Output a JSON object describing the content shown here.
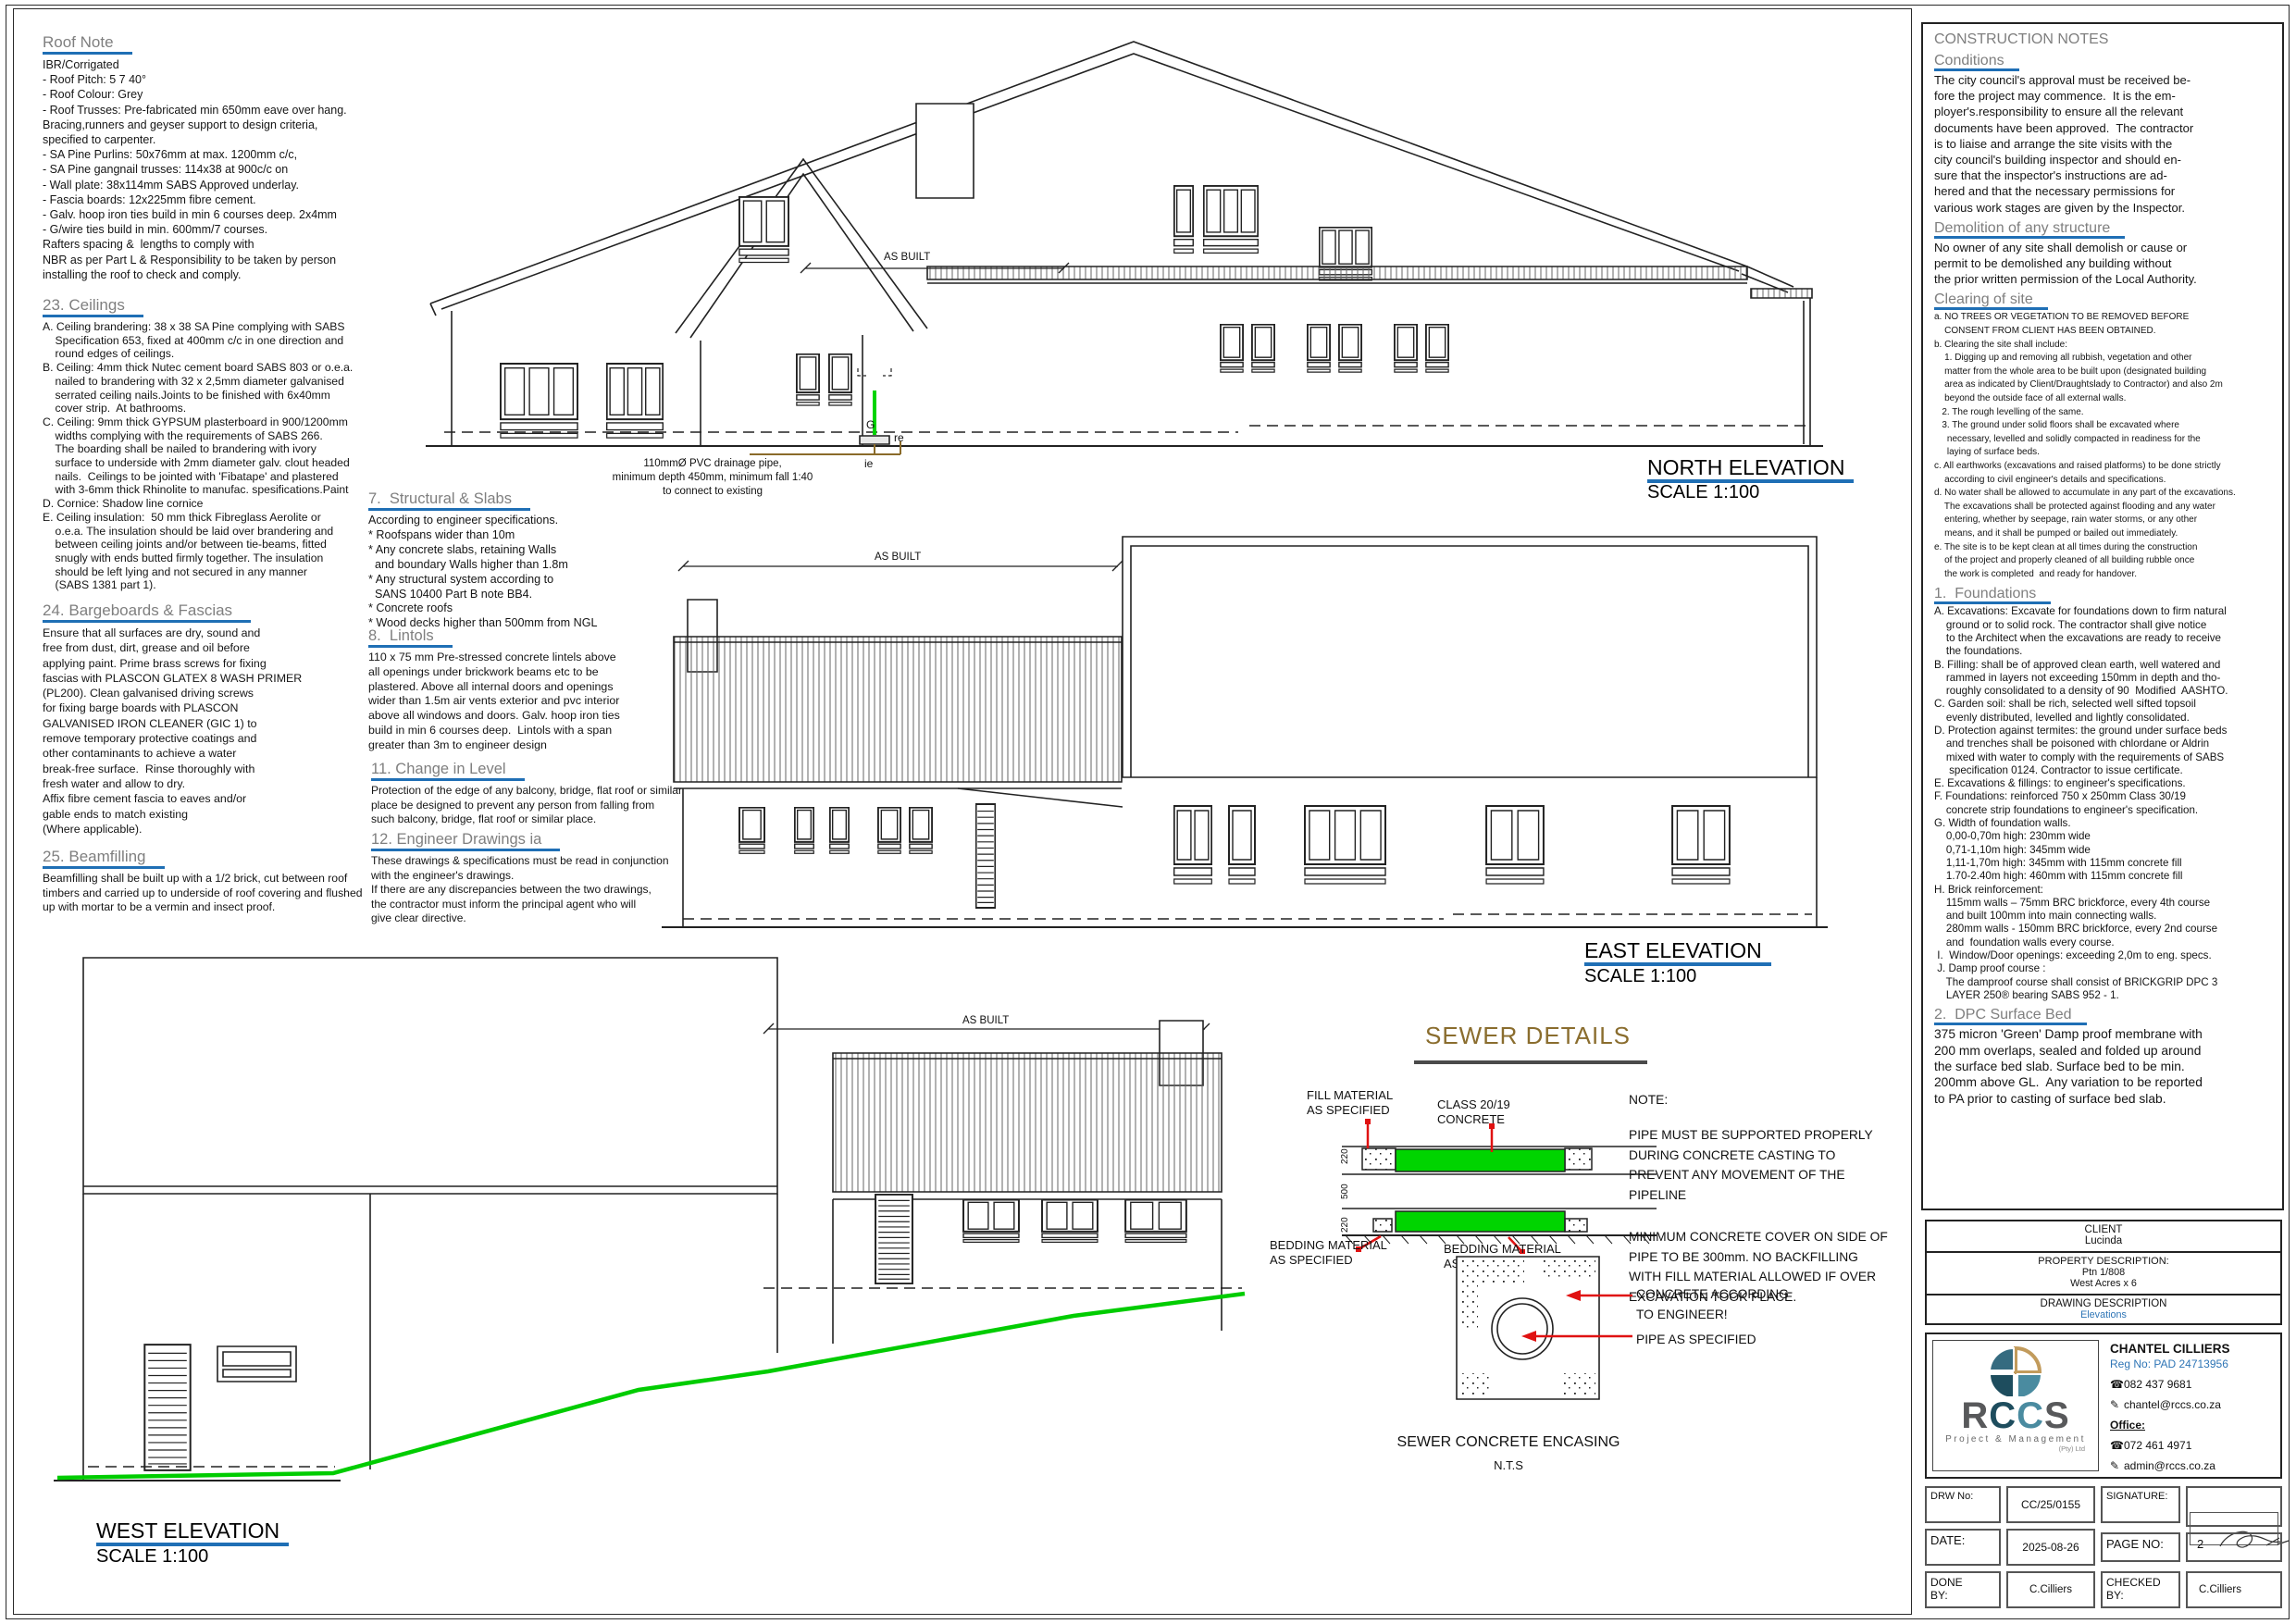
{
  "colors": {
    "accent_blue": "#1f6fb5",
    "link_blue": "#2e75b6",
    "heading_gray": "#7f7f7f",
    "pipe_green": "#00d400",
    "sewer_title_brown": "#8a6d2e",
    "leader_red": "#e01212"
  },
  "left": {
    "roof": {
      "title": "Roof Note",
      "lines": [
        "IBR/Corrigated",
        "- Roof Pitch: 5 7 40°",
        "- Roof Colour: Grey",
        "- Roof Trusses: Pre-fabricated min 650mm eave over hang.",
        "Bracing,runners and geyser support to design criteria,",
        "specified to carpenter.",
        "- SA Pine Purlins: 50x76mm at max. 1200mm c/c,",
        "- SA Pine gangnail trusses: 114x38 at 900c/c on",
        "- Wall plate: 38x114mm SABS Approved underlay.",
        "- Fascia boards: 12x225mm fibre cement.",
        "- Galv. hoop iron ties build in min 6 courses deep. 2x4mm",
        "- G/wire ties build in min. 600mm/7 courses.",
        "Rafters spacing &  lengths to comply with",
        "NBR as per Part L & Responsibility to be taken by person",
        "installing the roof to check and comply."
      ]
    },
    "ceilings": {
      "title": "23. Ceilings",
      "lines": [
        "A. Ceiling brandering: 38 x 38 SA Pine complying with SABS",
        "    Specification 653, fixed at 400mm c/c in one direction and",
        "    round edges of ceilings.",
        "B. Ceiling: 4mm thick Nutec cement board SABS 803 or o.e.a.",
        "    nailed to brandering with 32 x 2,5mm diameter galvanised",
        "    serrated ceiling nails.Joints to be finished with 6x40mm",
        "    cover strip.  At bathrooms.",
        "C. Ceiling: 9mm thick GYPSUM plasterboard in 900/1200mm",
        "    widths complying with the requirements of SABS 266.",
        "    The boarding shall be nailed to brandering with ivory",
        "    surface to underside with 2mm diameter galv. clout headed",
        "    nails.  Ceilings to be jointed with 'Fibatape' and plastered",
        "    with 3-6mm thick Rhinolite to manufac. spesifications.Paint",
        "D. Cornice: Shadow line cornice",
        "E. Ceiling insulation:  50 mm thick Fibreglass Aerolite or",
        "    o.e.a. The insulation should be laid over brandering and",
        "    between ceiling joints and/or between tie-beams, fitted",
        "    snugly with ends butted firmly together. The insulation",
        "    should be left lying and not secured in any manner",
        "    (SABS 1381 part 1)."
      ]
    },
    "bargeboards": {
      "title": "24. Bargeboards & Fascias",
      "lines": [
        "Ensure that all surfaces are dry, sound and",
        "free from dust, dirt, grease and oil before",
        "applying paint. Prime brass screws for fixing",
        "fascias with PLASCON GLATEX 8 WASH PRIMER",
        "(PL200). Clean galvanised driving screws",
        "for fixing barge boards with PLASCON",
        "GALVANISED IRON CLEANER (GIC 1) to",
        "remove temporary protective coatings and",
        "other contaminants to achieve a water",
        "break-free surface.  Rinse thoroughly with",
        "fresh water and allow to dry.",
        "Affix fibre cement fascia to eaves and/or",
        "gable ends to match existing",
        "(Where applicable)."
      ]
    },
    "beamfilling": {
      "title": "25. Beamfilling",
      "lines": [
        "Beamfilling shall be built up with a 1/2 brick, cut between roof",
        "timbers and carried up to underside of roof covering and flushed",
        "up with mortar to be a vermin and insect proof."
      ]
    }
  },
  "mid": {
    "structural": {
      "title": "7.  Structural & Slabs",
      "lines": [
        "According to engineer specifications.",
        "* Roofspans wider than 10m",
        "* Any concrete slabs, retaining Walls",
        "  and boundary Walls higher than 1.8m",
        "* Any structural system according to",
        "  SANS 10400 Part B note BB4.",
        "* Concrete roofs",
        "* Wood decks higher than 500mm from NGL"
      ]
    },
    "lintols": {
      "title": "8.  Lintols",
      "lines": [
        "110 x 75 mm Pre-stressed concrete lintels above",
        "all openings under brickwork beams etc to be",
        "plastered. Above all internal doors and openings",
        "wider than 1.5m air vents exterior and pvc interior",
        "above all windows and doors. Galv. hoop iron ties",
        "build in min 6 courses deep.  Lintols with a span",
        "greater than 3m to engineer design"
      ]
    },
    "change": {
      "title": "11. Change in Level",
      "lines": [
        "Protection of the edge of any balcony, bridge, flat roof or similar",
        "place be designed to prevent any person from falling from",
        "such balcony, bridge, flat roof or similar place."
      ]
    },
    "engineer": {
      "title": "12. Engineer Drawings ia",
      "lines": [
        "These drawings & specifications must be read in conjunction",
        "with the engineer's drawings.",
        "If there are any discrepancies between the two drawings,",
        "the contractor must inform the principal agent who will",
        "give clear directive."
      ]
    }
  },
  "north": {
    "title": "NORTH ELEVATION",
    "scale": "SCALE 1:100",
    "as_built": "AS BUILT",
    "pipe_note": [
      "110mmØ PVC drainage pipe,",
      "minimum depth 450mm, minimum fall 1:40",
      "to connect to existing"
    ],
    "g": "G",
    "re": "re",
    "ie": "ie"
  },
  "east": {
    "title": "EAST ELEVATION",
    "scale": "SCALE 1:100",
    "as_built": "AS BUILT"
  },
  "west": {
    "title": "WEST ELEVATION",
    "scale": "SCALE 1:100",
    "as_built": "AS BUILT"
  },
  "sewer": {
    "title": "SEWER DETAILS",
    "fill_label": [
      "FILL MATERIAL",
      "AS SPECIFIED"
    ],
    "class_label": [
      "CLASS 20/19",
      "CONCRETE"
    ],
    "note_label": "NOTE:",
    "note1": [
      "PIPE MUST BE SUPPORTED PROPERLY",
      "DURING CONCRETE CASTING TO",
      "PREVENT ANY MOVEMENT OF THE",
      "PIPELINE"
    ],
    "note2": [
      "MINIMUM CONCRETE COVER ON SIDE OF",
      "PIPE TO BE 300mm. NO BACKFILLING",
      "WITH FILL MATERIAL ALLOWED IF OVER",
      "EXCAVATION TOOK PLACE."
    ],
    "bedding1": [
      "BEDDING MATERIAL",
      "AS SPECIFIED"
    ],
    "bedding2": [
      "BEDDING MATERIAL",
      "AS SPECIFIED"
    ],
    "dim_top": "220",
    "dim_mid": "500",
    "dim_bot": "220",
    "enc_label1": [
      "CONCRETE ACCORDING",
      "TO ENGINEER!"
    ],
    "enc_label2": "PIPE AS SPECIFIED",
    "caption": "SEWER CONCRETE ENCASING",
    "nts": "N.T.S"
  },
  "rc": {
    "title": "CONSTRUCTION NOTES",
    "conditions": {
      "title": "Conditions",
      "lines": [
        "The city council's approval must be received be-",
        "fore the project may commence.  It is the em-",
        "ployer's.responsibility to ensure all the relevant",
        "documents have been approved.  The contractor",
        "is to liaise and arrange the site visits with the",
        "city council's building inspector and should en-",
        "sure that the inspector's instructions are ad-",
        "hered and that the necessary permissions for",
        "various work stages are given by the Inspector."
      ]
    },
    "demolition": {
      "title": "Demolition of any structure",
      "lines": [
        "No owner of any site shall demolish or cause or",
        "permit to be demolished any building without",
        "the prior written permission of the Local Authority."
      ]
    },
    "clearing": {
      "title": "Clearing of site",
      "lines": [
        "a. NO TREES OR VEGETATION TO BE REMOVED BEFORE",
        "    CONSENT FROM CLIENT HAS BEEN OBTAINED.",
        "b. Clearing the site shall include:",
        "    1. Digging up and removing all rubbish, vegetation and other",
        "    matter from the whole area to be built upon (designated building",
        "    area as indicated by Client/Draughtslady to Contractor) and also 2m",
        "    beyond the outside face of all external walls.",
        "   2. The rough levelling of the same.",
        "   3. The ground under solid floors shall be excavated where",
        "     necessary, levelled and solidly compacted in readiness for the",
        "     laying of surface beds.",
        "c. All earthworks (excavations and raised platforms) to be done strictly",
        "    according to civil engineer's details and specifications.",
        "d. No water shall be allowed to accumulate in any part of the excavations.",
        "    The excavations shall be protected against flooding and any water",
        "    entering, whether by seepage, rain water storms, or any other",
        "    means, and it shall be pumped or bailed out immediately.",
        "e. The site is to be kept clean at all times during the construction",
        "    of the project and properly cleaned of all building rubble once",
        "    the work is completed  and ready for handover."
      ]
    },
    "foundations": {
      "title": "1.  Foundations",
      "lines": [
        "A. Excavations: Excavate for foundations down to firm natural",
        "    ground or to solid rock. The contractor shall give notice",
        "    to the Architect when the excavations are ready to receive",
        "    the foundations.",
        "B. Filling: shall be of approved clean earth, well watered and",
        "    rammed in layers not exceeding 150mm in depth and tho-",
        "    roughly consolidated to a density of 90  Modified  AASHTO.",
        "C. Garden soil: shall be rich, selected well sifted topsoil",
        "    evenly distributed, levelled and lightly consolidated.",
        "D. Protection against termites: the ground under surface beds",
        "    and trenches shall be poisoned with chlordane or Aldrin",
        "    mixed with water to comply with the requirements of SABS",
        "     specification 0124. Contractor to issue certificate.",
        "E. Excavations & fillings: to engineer's specifications.",
        "F. Foundations: reinforced 750 x 250mm Class 30/19",
        "    concrete strip foundations to engineer's specification.",
        "G. Width of foundation walls.",
        "    0,00-0,70m high: 230mm wide",
        "    0,71-1,10m high: 345mm wide",
        "    1,11-1,70m high: 345mm with 115mm concrete fill",
        "    1.70-2.40m high: 460mm with 115mm concrete fill",
        "H. Brick reinforcement:",
        "    115mm walls – 75mm BRC brickforce, every 4th course",
        "    and built 100mm into main connecting walls.",
        "    280mm walls - 150mm BRC brickforce, every 2nd course",
        "    and  foundation walls every course.",
        " I.  Window/Door openings: exceeding 2,0m to eng. specs.",
        " J. Damp proof course :",
        "    The damproof course shall consist of BRICKGRIP DPC 3",
        "    LAYER 250® bearing SABS 952 - 1."
      ]
    },
    "dpc": {
      "title": "2.  DPC Surface Bed",
      "lines": [
        "375 micron 'Green' Damp proof membrane with",
        "200 mm overlaps, sealed and folded up around",
        "the surface bed slab. Surface bed to be min.",
        "200mm above GL.  Any variation to be reported",
        "to PA prior to casting of surface bed slab."
      ]
    }
  },
  "tb": {
    "client_label": "CLIENT",
    "client": "Lucinda",
    "prop_label": "PROPERTY DESCRIPTION:",
    "prop1": "Ptn 1/808",
    "prop2": "West Acres x 6",
    "draw_label": "DRAWING DESCRIPTION",
    "drawing": "Elevations"
  },
  "firm": {
    "r": "R",
    "c1": "C",
    "c2": "C",
    "s": "S",
    "subtitle": "Project & Management",
    "pty": "(Pty) Ltd",
    "name": "CHANTEL CILLIERS",
    "reg": "Reg No: PAD 24713956",
    "phone_icon": "☎",
    "mail_icon": "✎",
    "phone1": "082 437 9681",
    "email1": "chantel@rccs.co.za",
    "office": "Office:",
    "phone2": "072 461 4971",
    "email2": "admin@rccs.co.za"
  },
  "footer": {
    "drw_label": "DRW No:",
    "drw": "CC/25/0155",
    "sig_label": "SIGNATURE:",
    "date_label": "DATE:",
    "date": "2025-08-26",
    "page_label": "PAGE NO:",
    "page": "2",
    "done_label": "DONE\nBY:",
    "done": "C.Cilliers",
    "checked_label": "CHECKED\nBY:",
    "checked": "C.Cilliers"
  }
}
